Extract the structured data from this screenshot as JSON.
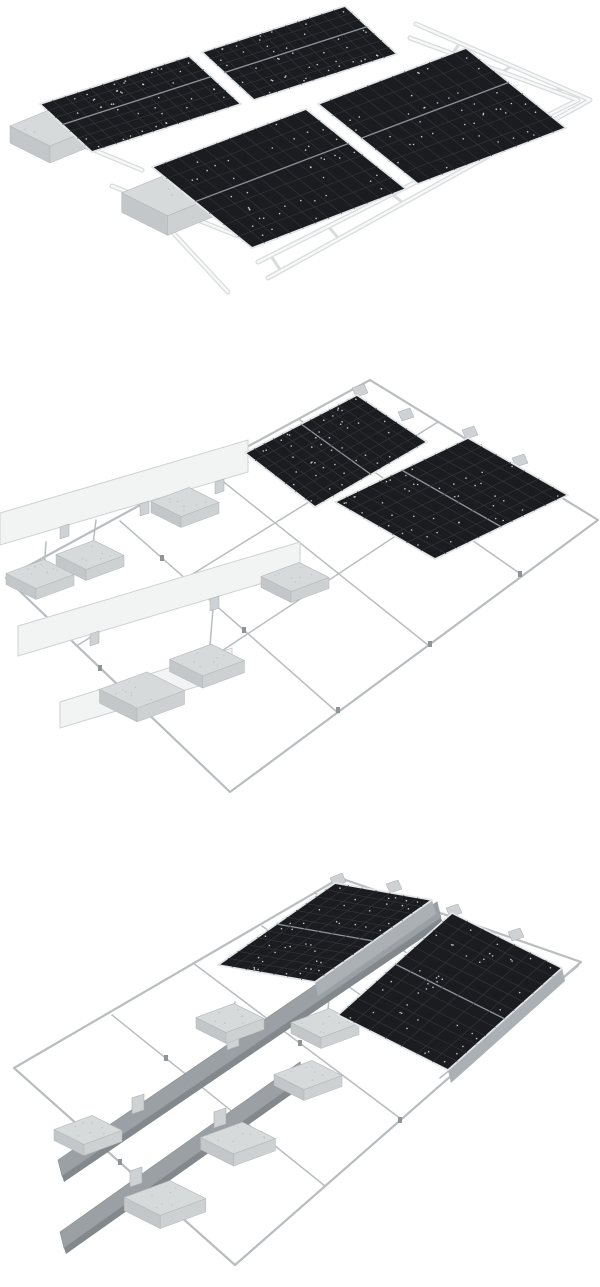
{
  "page": {
    "background": "#ffffff",
    "kind": "product-render-stack"
  },
  "colors": {
    "bg": "#ffffff",
    "panel_dark": "#1a1c1f",
    "panel_line": "#35383d",
    "panel_divider": "#8e959b",
    "panel_dot": "#e4e7ea",
    "panel_frame": "#e2e5e7",
    "rail_silver": "#b9bdbf",
    "clamp": "#8f9497",
    "ladder_edge": "#d9dcdd",
    "ladder_core": "#f7f8f8",
    "concrete_top": "#d7dadb",
    "concrete_left": "#c3c7c9",
    "concrete_right": "#cdd1d2",
    "concrete_edge": "#b2b6b8",
    "concrete_speckle": "#b7bbbd",
    "deflector_fill": "#f2f4f4",
    "deflector_edge": "#cdd1d2",
    "beam_fill": "#9aa0a3",
    "beam_dark": "#82888b",
    "beam_edge": "#8d9295",
    "bracket_fill": "#ced2d4",
    "bracket_edge": "#a6abad",
    "wall": "#aab0b3"
  },
  "scenes": [
    {
      "id": "assembled-array",
      "label": "Assembled ballasted solar array",
      "panels": 4,
      "ballast_blocks": 2,
      "alt": "Fully assembled ballasted solar mounting system: four black solar panels in two rows on a white ladder rail frame with two concrete ballast blocks at the left"
    },
    {
      "id": "frame-with-deflectors",
      "label": "Mounting frame with wind deflector rows",
      "panels": 2,
      "ballast_blocks": 6,
      "deflector_rows": 3,
      "alt": "Ballasted mounting frame layout: thin aluminum rail grid, three white wind deflector rows, six concrete ballast pavers and two black solar panels installed at the upper right"
    },
    {
      "id": "tilt-up-frame",
      "label": "Tilt-up frame with ballast beams",
      "panels": 2,
      "ballast_blocks": 6,
      "deflector_beams": 2,
      "alt": "Tilt-up ballasted mounting frame: two raised black solar panels, two long gray ballast beams with support brackets, six concrete pavers on a thin rail grid"
    }
  ]
}
